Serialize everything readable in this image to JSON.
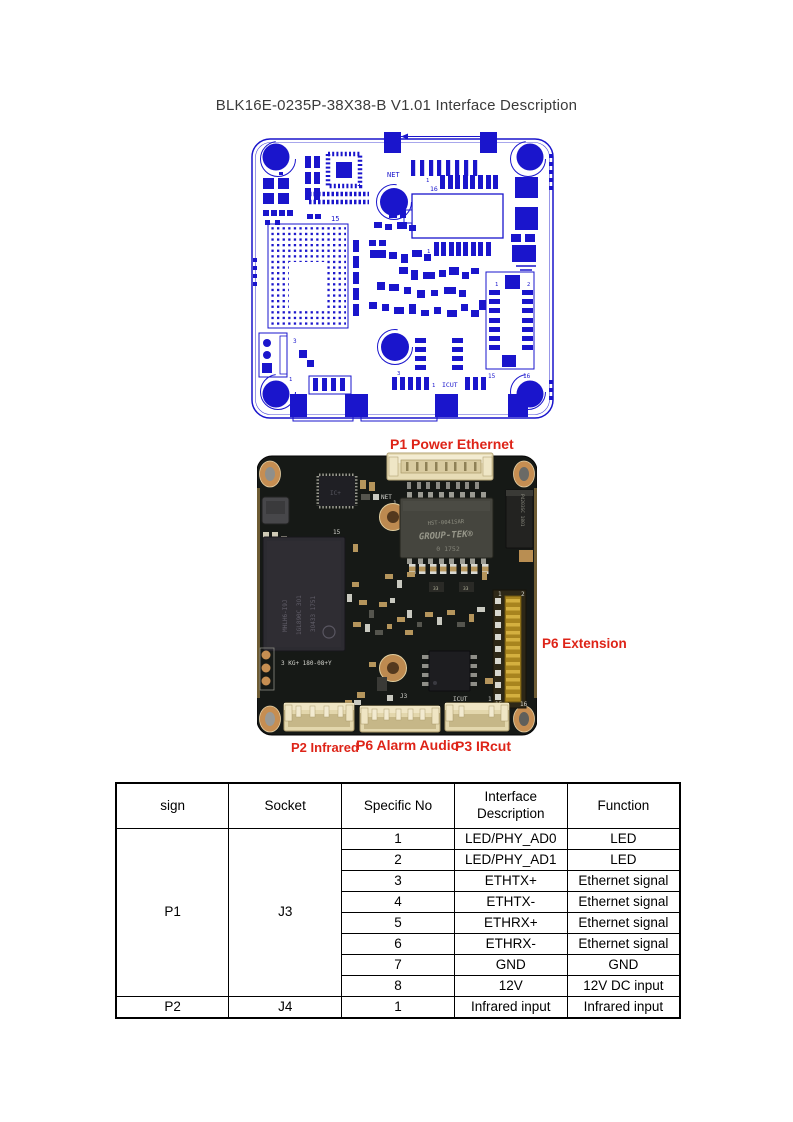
{
  "page": {
    "title": "BLK16E-0235P-38X38-B V1.01 Interface Description"
  },
  "colors": {
    "diagram_blue": "#1a15cc",
    "label_red": "#de2418",
    "board_dark": "#161916"
  },
  "diagram": {
    "net": "NET",
    "icut": "ICUT",
    "n1": "1",
    "n2": "2",
    "n3": "3",
    "n15": "15",
    "n16": "16"
  },
  "photo": {
    "silk": {
      "net": "NET",
      "n1": "1",
      "n2": "2",
      "n15": "15",
      "n16": "16",
      "j3": "J3",
      "icut": "ICUT",
      "kg": "3  KG+ 180-08+Y"
    },
    "parts": {
      "transformer_l1": "HST-0041SAR",
      "transformer_l2": "GROUP-TEK®",
      "transformer_l3": "0   1752",
      "side_chip": "P4203SC 1801",
      "qfp": "IC+",
      "r33": "33",
      "mainchip_l1": "MHLH6-I9J",
      "mainchip_l2": "1GL890C 3O1",
      "mainchip_l3": "3O433 1751"
    }
  },
  "labels": {
    "p1": "P1 Power Ethernet",
    "p6_ext": "P6 Extension",
    "p2": "P2 Infrared",
    "p6_alarm": "P6 Alarm Audio",
    "p3": "P3 IRcut"
  },
  "table": {
    "headers": [
      "sign",
      "Socket",
      "Specific No",
      "Interface Description",
      "Function"
    ],
    "groups": [
      {
        "sign": "P1",
        "socket": "J3",
        "rows": [
          {
            "no": "1",
            "desc": "LED/PHY_AD0",
            "func": "LED"
          },
          {
            "no": "2",
            "desc": "LED/PHY_AD1",
            "func": "LED"
          },
          {
            "no": "3",
            "desc": "ETHTX+",
            "func": "Ethernet signal"
          },
          {
            "no": "4",
            "desc": "ETHTX-",
            "func": "Ethernet signal"
          },
          {
            "no": "5",
            "desc": "ETHRX+",
            "func": "Ethernet signal"
          },
          {
            "no": "6",
            "desc": "ETHRX-",
            "func": "Ethernet signal"
          },
          {
            "no": "7",
            "desc": "GND",
            "func": "GND"
          },
          {
            "no": "8",
            "desc": "12V",
            "func": "12V DC input"
          }
        ]
      },
      {
        "sign": "P2",
        "socket": "J4",
        "rows": [
          {
            "no": "1",
            "desc": "Infrared input",
            "func": "Infrared input"
          }
        ]
      }
    ]
  }
}
